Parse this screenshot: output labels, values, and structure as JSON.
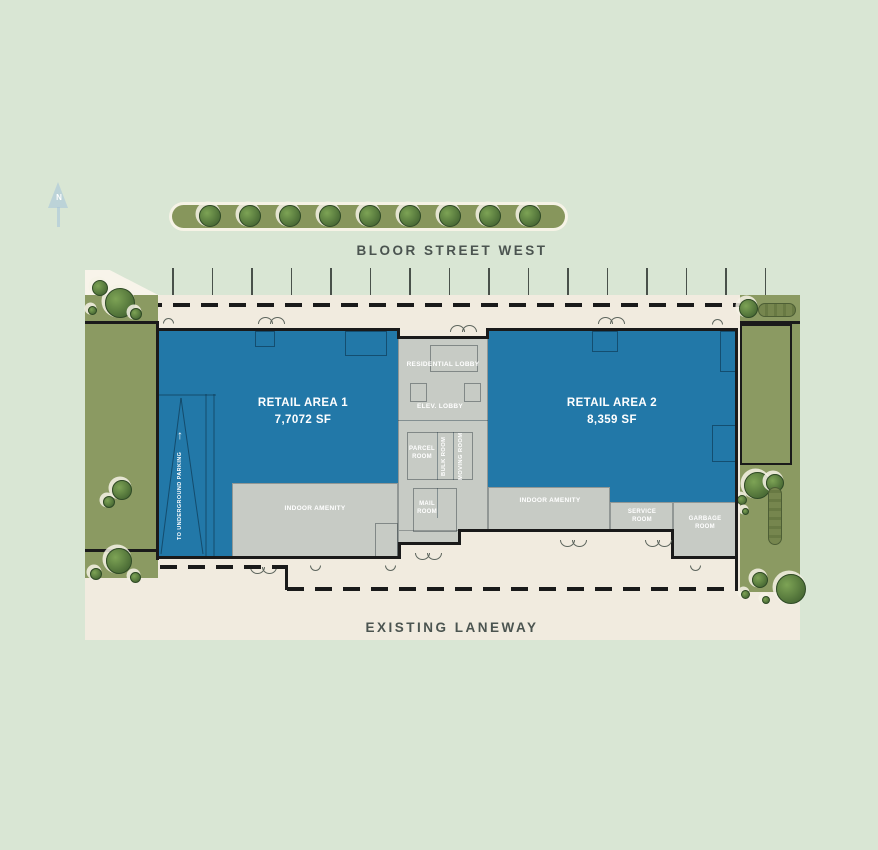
{
  "plan": {
    "compass_label": "N",
    "street_top": "BLOOR STREET WEST",
    "street_bottom": "EXISTING LANEWAY",
    "retail_area_1": {
      "label": "RETAIL AREA 1",
      "area": "7,7072 SF"
    },
    "retail_area_2": {
      "label": "RETAIL AREA 2",
      "area": "8,359 SF"
    },
    "rooms": {
      "residential_lobby": "RESIDENTIAL LOBBY",
      "elev_lobby": "ELEV. LOBBY",
      "parcel_room": "PARCEL ROOM",
      "bulk_room": "BULK ROOM",
      "moving_room": "MOVING ROOM",
      "mail_room": "MAIL ROOM",
      "indoor_amenity_left": "INDOOR AMENITY",
      "indoor_amenity_right": "INDOOR AMENITY",
      "service_room": "SERVICE ROOM",
      "garbage_room": "GARBAGE ROOM"
    },
    "ramp_label": "TO UNDERGROUND PARKING",
    "ramp_arrow": "↑",
    "colors": {
      "background": "#d9e6d4",
      "pavement": "#f1ebdf",
      "landscape_green": "#8b9a62",
      "median_green": "#87965c",
      "retail_blue": "#2278a8",
      "core_gray": "#c7cbc5",
      "outline_black": "#1a1a1a",
      "street_text": "#4b5450",
      "room_text": "#ffffff",
      "north_arrow_blue": "#a8c7db"
    }
  }
}
